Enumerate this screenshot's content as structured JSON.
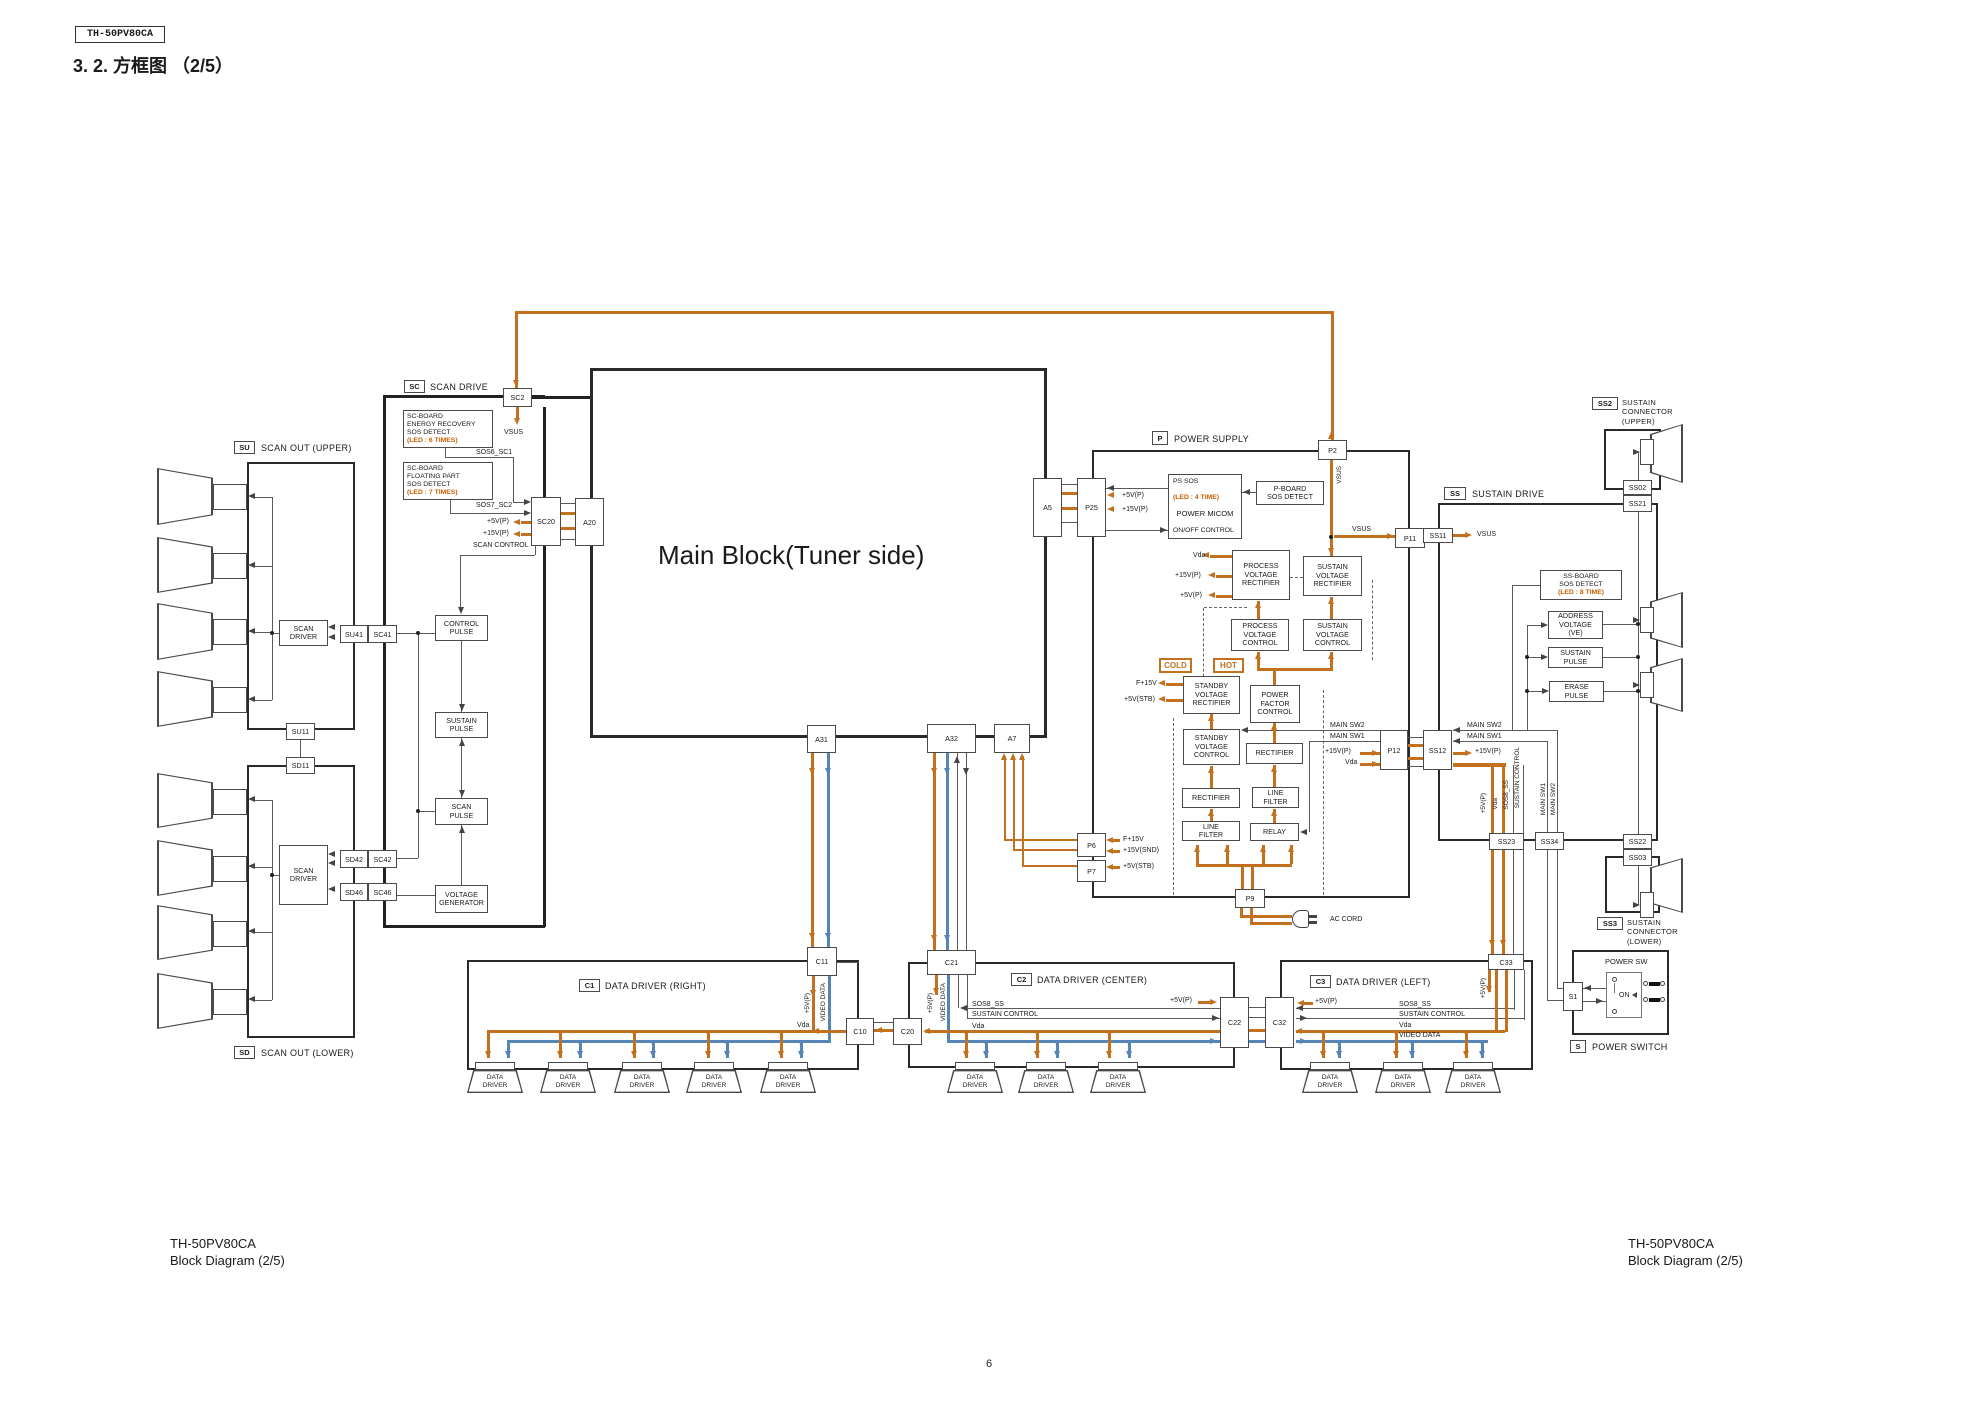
{
  "page": {
    "model_tag": "TH-50PV80CA",
    "title": "3. 2.    方框图 （2/5）",
    "footer_model": "TH-50PV80CA",
    "footer_caption": "Block Diagram (2/5)",
    "page_number": "6"
  },
  "sections": {
    "su": {
      "tag": "SU",
      "label": "SCAN OUT (UPPER)"
    },
    "sd": {
      "tag": "SD",
      "label": "SCAN OUT (LOWER)"
    },
    "sc": {
      "tag": "SC",
      "label": "SCAN DRIVE"
    },
    "p": {
      "tag": "P",
      "label": "POWER SUPPLY"
    },
    "ss": {
      "tag": "SS",
      "label": "SUSTAIN DRIVE"
    },
    "ss2": {
      "tag": "SS2",
      "label": "SUSTAIN\nCONNECTOR\n(UPPER)"
    },
    "ss3": {
      "tag": "SS3",
      "label": "SUSTAIN\nCONNECTOR\n(LOWER)"
    },
    "c1": {
      "tag": "C1",
      "label": "DATA DRIVER (RIGHT)"
    },
    "c2": {
      "tag": "C2",
      "label": "DATA DRIVER (CENTER)"
    },
    "c3": {
      "tag": "C3",
      "label": "DATA DRIVER (LEFT)"
    },
    "s": {
      "tag": "S",
      "label": "POWER SWITCH",
      "box_label": "POWER SW",
      "on_label": "ON"
    },
    "main": {
      "label": "Main Block(Tuner side)"
    }
  },
  "blocks": {
    "sc_energy_recovery": "SC-BOARD\nENERGY RECOVERY\nSOS DETECT",
    "sc_energy_recovery_led": "(LED : 6 TIMES)",
    "sc_floating": "SC-BOARD\nFLOATING PART\nSOS DETECT",
    "sc_floating_led": "(LED : 7 TIMES)",
    "control_pulse": "CONTROL\nPULSE",
    "sustain_pulse": "SUSTAIN\nPULSE",
    "scan_pulse": "SCAN\nPULSE",
    "voltage_generator": "VOLTAGE\nGENERATOR",
    "scan_driver": "SCAN\nDRIVER",
    "data_driver": "DATA\nDRIVER",
    "ps_sos": "PS SOS",
    "ps_sos_led": "(LED : 4 TIME)",
    "power_micom": "POWER MICOM",
    "on_off_control": "ON/OFF CONTROL",
    "p_board_sos": "P-BOARD\nSOS DETECT",
    "process_voltage_rectifier": "PROCESS\nVOLTAGE\nRECTIFIER",
    "sustain_voltage_rectifier": "SUSTAIN\nVOLTAGE\nRECTIFIER",
    "process_voltage_control": "PROCESS\nVOLTAGE\nCONTROL",
    "sustain_voltage_control": "SUSTAIN\nVOLTAGE\nCONTROL",
    "standby_voltage_rectifier": "STANDBY\nVOLTAGE\nRECTIFIER",
    "standby_voltage_control": "STANDBY\nVOLTAGE\nCONTROL",
    "power_factor_control": "POWER\nFACTOR\nCONTROL",
    "rectifier": "RECTIFIER",
    "line_filter": "LINE\nFILTER",
    "relay": "RELAY",
    "cold": "COLD",
    "hot": "HOT",
    "ss_board_sos": "SS-BOARD\nSOS DETECT",
    "ss_board_sos_led": "(LED : 8 TIME)",
    "address_voltage": "ADDRESS\nVOLTAGE\n(VE)",
    "erase_pulse": "ERASE\nPULSE"
  },
  "conn": {
    "sc2": "SC2",
    "sc20": "SC20",
    "a20": "A20",
    "su41": "SU41",
    "sc41": "SC41",
    "su11": "SU11",
    "sd11": "SD11",
    "sd42": "SD42",
    "sc42": "SC42",
    "sd46": "SD46",
    "sc46": "SC46",
    "a31": "A31",
    "a32": "A32",
    "a7": "A7",
    "a5": "A5",
    "p25": "P25",
    "p2": "P2",
    "p11": "P11",
    "p12": "P12",
    "p6": "P6",
    "p7": "P7",
    "p9": "P9",
    "ss11": "SS11",
    "ss12": "SS12",
    "ss02": "SS02",
    "ss21": "SS21",
    "ss22": "SS22",
    "ss03": "SS03",
    "ss23": "SS23",
    "ss34": "SS34",
    "c11": "C11",
    "c21": "C21",
    "c33": "C33",
    "c10": "C10",
    "c20": "C20",
    "c22": "C22",
    "c32": "C32",
    "s1": "S1"
  },
  "sig": {
    "vsus": "VSUS",
    "sos6": "SOS6_SC1",
    "sos7": "SOS7_SC2",
    "p5v": "+5V(P)",
    "p15v": "+15V(P)",
    "scan_control": "SCAN CONTROL",
    "vda": "Vda",
    "f15v": "F+15V",
    "v5stb": "+5V(STB)",
    "v15snd": "+15V(SND)",
    "main_sw1": "MAIN SW1",
    "main_sw2": "MAIN SW2",
    "ac_cord": "AC CORD",
    "sos8": "SOS8_SS",
    "sustain_control": "SUSTAIN CONTROL",
    "video_data": "VIDEO DATA"
  },
  "colors": {
    "power_line": "#c4711f",
    "video_line": "#5585b5",
    "led_text": "#c65f00",
    "line": "#4a4a4a"
  }
}
